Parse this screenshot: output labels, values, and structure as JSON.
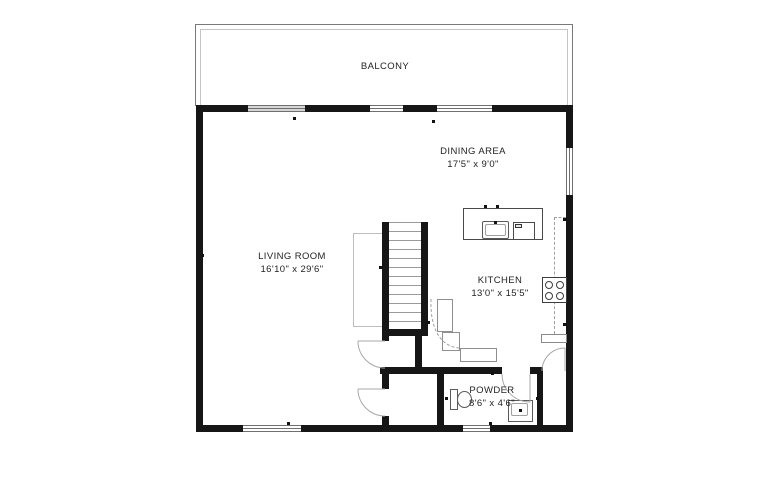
{
  "rooms": {
    "balcony": {
      "name": "BALCONY"
    },
    "dining": {
      "name": "DINING AREA",
      "dims": "17'5\" x 9'0\""
    },
    "living": {
      "name": "LIVING ROOM",
      "dims": "16'10\" x 29'6\""
    },
    "kitchen": {
      "name": "KITCHEN",
      "dims": "13'0\" x 15'5\""
    },
    "powder": {
      "name": "POWDER",
      "dims": "8'6\" x 4'6\""
    }
  },
  "fixtures": {
    "stairs": "staircase",
    "island_sink": "kitchen-sink",
    "island_appliance": "dishwasher",
    "cooktop": "four-burner-cooktop",
    "toilet": "toilet",
    "powder_sink": "bathroom-sink"
  },
  "colors": {
    "wall": "#161616",
    "thin_line": "#9b9b9b",
    "window_line": "#6f6f6f",
    "text": "#232323",
    "background": "#ffffff"
  }
}
